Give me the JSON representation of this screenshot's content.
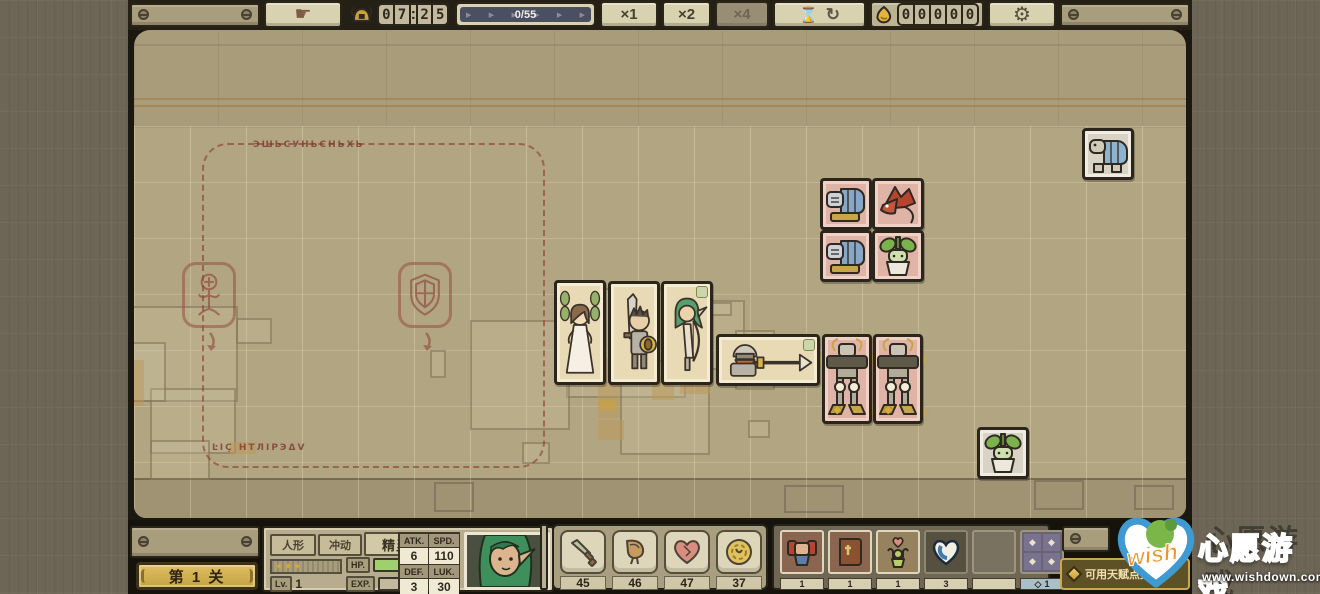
{
  "icons": {
    "hand": "☛",
    "hourglass": "⌛",
    "loop": "↻",
    "gear": "⚙",
    "arrow": "▶",
    "colon": ":",
    "diamond": "◆",
    "diamond_outline": "◇"
  },
  "top_bar": {
    "timer": {
      "digits": [
        "0",
        "7",
        "2",
        "5"
      ]
    },
    "progress": "0/55",
    "speed": {
      "x1": "×1",
      "x2": "×2",
      "x4": "×4"
    },
    "coins": [
      "0",
      "0",
      "0",
      "0",
      "0"
    ]
  },
  "board": {
    "zone_title": "ЭШЬCУНЬCНЬXЬ",
    "zone_footer": "ĿIÇ НТЛIРЭΔV"
  },
  "hud": {
    "stage": "第 1 关",
    "character": {
      "tag1": "人形",
      "tag2": "冲动",
      "name": "精灵猎手",
      "stars": "★★★",
      "lv_label": "Lv.",
      "lv": "1",
      "hp_label": "HP.",
      "hp": "42/42",
      "exp_label": "EXP.",
      "exp": "0/1400",
      "atk_label": "ATK.",
      "atk": "6",
      "spd_label": "SPD.",
      "spd": "110",
      "def_label": "DEF.",
      "def": "3",
      "luk_label": "LUK.",
      "luk": "30"
    },
    "resources": {
      "sword": "45",
      "meat": "46",
      "heart": "47",
      "coin": "37"
    },
    "items": {
      "warrior": "1",
      "book": "1",
      "worship": "1",
      "shield": "3",
      "talent": "1"
    },
    "talent_label": "可用天赋点数:"
  },
  "watermark": {
    "wish": "wish",
    "title": "心愿游戏",
    "url": "www.wishdown.com"
  }
}
